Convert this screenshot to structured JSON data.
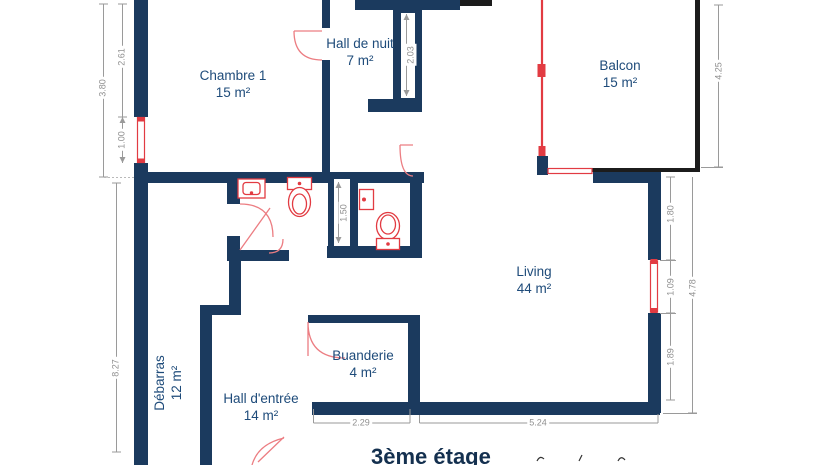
{
  "floor_title": {
    "text": "3ème étage"
  },
  "rooms": [
    {
      "name": "Chambre 1",
      "area": "15 m²"
    },
    {
      "name": "Hall de nuit",
      "area": "7 m²"
    },
    {
      "name": "Balcon",
      "area": "15 m²"
    },
    {
      "name": "Living",
      "area": "44 m²"
    },
    {
      "name": "Buanderie",
      "area": "4 m²"
    },
    {
      "name": "Hall d'entrée",
      "area": "14 m²"
    },
    {
      "name": "Débarras",
      "area": "12 m²"
    }
  ],
  "dimensions": {
    "left_overall": "3.80",
    "left_upper": "2.61",
    "left_window": "1.00",
    "left_lower": "8.27",
    "corridor_wall": "2.03",
    "bath_core": "1.50",
    "balcony_right": "4.25",
    "living_upper": "1.80",
    "living_window": "1.09",
    "living_lower": "1.89",
    "living_overall": "4.78",
    "bottom_buanderie": "2.29",
    "bottom_living": "5.24"
  },
  "colors": {
    "wall": "#1b3a5e",
    "black_wall": "#1c1c1c",
    "red": "#e23b42",
    "red_light": "#ec7d82",
    "label": "#1e4b7a",
    "dim": "#8f8f8f",
    "title": "#14304f",
    "bg": "#ffffff"
  }
}
